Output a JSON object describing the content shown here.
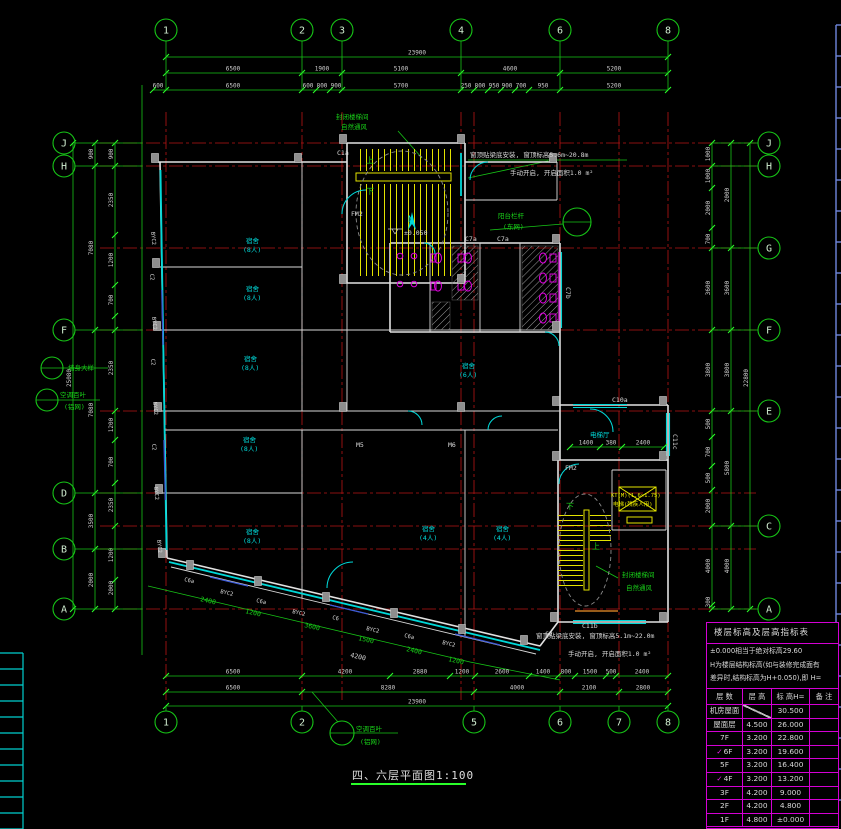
{
  "title_block": {
    "name": "四、六层平面图",
    "scale": "1:100"
  },
  "legend_table": {
    "title": "楼层标高及层高指标表",
    "notes": [
      "±0.000相当于绝对标高29.60",
      "H为楼层结构标高(如与装修完成面有",
      "差异时,结构标高为H+0.050),即 H="
    ],
    "headers": [
      "层 数",
      "层 高",
      "标 高H=",
      "备 注"
    ],
    "check_glyph": "✓",
    "rows": [
      {
        "floor": "机房屋面",
        "height": "",
        "elev": "30.500",
        "remark": "",
        "checked": false,
        "diag": true
      },
      {
        "floor": "屋面层",
        "height": "4.500",
        "elev": "26.000",
        "remark": "",
        "checked": false
      },
      {
        "floor": "7F",
        "height": "3.200",
        "elev": "22.800",
        "remark": "",
        "checked": false
      },
      {
        "floor": "6F",
        "height": "3.200",
        "elev": "19.600",
        "remark": "",
        "checked": true
      },
      {
        "floor": "5F",
        "height": "3.200",
        "elev": "16.400",
        "remark": "",
        "checked": false
      },
      {
        "floor": "4F",
        "height": "3.200",
        "elev": "13.200",
        "remark": "",
        "checked": true
      },
      {
        "floor": "3F",
        "height": "4.200",
        "elev": "9.000",
        "remark": "",
        "checked": false
      },
      {
        "floor": "2F",
        "height": "4.200",
        "elev": "4.800",
        "remark": "",
        "checked": false
      },
      {
        "floor": "1F",
        "height": "4.800",
        "elev": "±0.000",
        "remark": "",
        "checked": false
      }
    ]
  },
  "bubbles": {
    "top": [
      [
        "1",
        166
      ],
      [
        "2",
        302
      ],
      [
        "3",
        342
      ],
      [
        "4",
        461
      ],
      [
        "6",
        560
      ],
      [
        "8",
        668
      ]
    ],
    "bottom": [
      [
        "1",
        166
      ],
      [
        "2",
        302
      ],
      [
        "5",
        474
      ],
      [
        "6",
        560
      ],
      [
        "7",
        619
      ],
      [
        "8",
        668
      ]
    ],
    "left": [
      [
        "J",
        143
      ],
      [
        "H",
        166
      ],
      [
        "F",
        330
      ],
      [
        "D",
        493
      ],
      [
        "B",
        549
      ],
      [
        "A",
        609
      ]
    ],
    "right": [
      [
        "J",
        143
      ],
      [
        "H",
        166
      ],
      [
        "G",
        248
      ],
      [
        "F",
        330
      ],
      [
        "E",
        411
      ],
      [
        "C",
        526
      ],
      [
        "A",
        609
      ]
    ]
  },
  "detail_circles": [
    {
      "x": 52,
      "y": 368,
      "r": 11
    },
    {
      "x": 47,
      "y": 400,
      "r": 11
    },
    {
      "x": 342,
      "y": 733,
      "r": 12
    },
    {
      "x": 577,
      "y": 222,
      "r": 14
    }
  ],
  "dim_chains": [
    {
      "o": "h",
      "p": 57,
      "a": 166,
      "b": 668,
      "t": [
        166,
        668
      ],
      "l": [
        [
          "23900",
          417
        ]
      ]
    },
    {
      "o": "h",
      "p": 73,
      "a": 166,
      "b": 668,
      "t": [
        166,
        302,
        342,
        461,
        560,
        668
      ],
      "l": [
        [
          "6500",
          233
        ],
        [
          "1900",
          322
        ],
        [
          "5100",
          401
        ],
        [
          "4600",
          510
        ],
        [
          "5200",
          614
        ]
      ]
    },
    {
      "o": "h",
      "p": 90,
      "a": 153,
      "b": 668,
      "t": [
        153,
        166,
        302,
        316,
        330,
        342,
        461,
        474,
        488,
        501,
        515,
        529,
        560,
        668
      ],
      "l": [
        [
          "600",
          158
        ],
        [
          "6500",
          233
        ],
        [
          "600",
          308
        ],
        [
          "800",
          322
        ],
        [
          "900",
          336
        ],
        [
          "5700",
          401
        ],
        [
          "250",
          466
        ],
        [
          "800",
          480
        ],
        [
          "950",
          494
        ],
        [
          "900",
          507
        ],
        [
          "700",
          521
        ],
        [
          "950",
          543
        ],
        [
          "5200",
          614
        ]
      ]
    },
    {
      "o": "h",
      "p": 676,
      "a": 166,
      "b": 668,
      "t": [
        166,
        302,
        390,
        450,
        475,
        529,
        558,
        575,
        606,
        616,
        668
      ],
      "l": [
        [
          "6500",
          233
        ],
        [
          "4200",
          345
        ],
        [
          "2880",
          420
        ],
        [
          "1200",
          462
        ],
        [
          "2600",
          502
        ],
        [
          "1400",
          543
        ],
        [
          "800",
          566
        ],
        [
          "1500",
          590
        ],
        [
          "500",
          611
        ],
        [
          "2400",
          642
        ]
      ]
    },
    {
      "o": "h",
      "p": 692,
      "a": 166,
      "b": 668,
      "t": [
        166,
        302,
        474,
        560,
        619,
        668
      ],
      "l": [
        [
          "6500",
          233
        ],
        [
          "8280",
          388
        ],
        [
          "4000",
          517
        ],
        [
          "2100",
          589
        ],
        [
          "2800",
          643
        ]
      ]
    },
    {
      "o": "h",
      "p": 706,
      "a": 166,
      "b": 668,
      "t": [
        166,
        668
      ],
      "l": [
        [
          "23900",
          417
        ]
      ]
    },
    {
      "o": "h",
      "p": 447,
      "a": 570,
      "b": 664,
      "t": [
        570,
        600,
        622,
        664
      ],
      "l": [
        [
          "1400",
          586
        ],
        [
          "380",
          611
        ],
        [
          "2400",
          643
        ]
      ]
    },
    {
      "o": "v",
      "p": 73,
      "a": 143,
      "b": 609,
      "t": [
        143,
        609
      ],
      "l": [
        [
          "25080",
          378
        ]
      ]
    },
    {
      "o": "v",
      "p": 95,
      "a": 143,
      "b": 609,
      "t": [
        143,
        166,
        330,
        493,
        549,
        609
      ],
      "l": [
        [
          "900",
          154
        ],
        [
          "7080",
          248
        ],
        [
          "7080",
          410
        ],
        [
          "3500",
          521
        ],
        [
          "2000",
          580
        ]
      ]
    },
    {
      "o": "v",
      "p": 115,
      "a": 143,
      "b": 609,
      "t": [
        143,
        166,
        235,
        285,
        316,
        330,
        411,
        440,
        483,
        526,
        580,
        609
      ],
      "l": [
        [
          "900",
          154
        ],
        [
          "2350",
          200
        ],
        [
          "1200",
          260
        ],
        [
          "700",
          300
        ],
        [
          "2350",
          368
        ],
        [
          "1200",
          425
        ],
        [
          "700",
          462
        ],
        [
          "2350",
          505
        ],
        [
          "1200",
          555
        ],
        [
          "2000",
          588
        ]
      ]
    },
    {
      "o": "v",
      "p": 712,
      "a": 143,
      "b": 609,
      "t": [
        143,
        166,
        188,
        228,
        248,
        330,
        411,
        437,
        466,
        490,
        526,
        605,
        609
      ],
      "l": [
        [
          "1000",
          154
        ],
        [
          "1000",
          176
        ],
        [
          "2000",
          208
        ],
        [
          "700",
          239
        ],
        [
          "3600",
          288
        ],
        [
          "3800",
          370
        ],
        [
          "500",
          424
        ],
        [
          "700",
          452
        ],
        [
          "500",
          478
        ],
        [
          "2000",
          506
        ],
        [
          "4000",
          566
        ],
        [
          "300",
          602
        ]
      ]
    },
    {
      "o": "v",
      "p": 731,
      "a": 143,
      "b": 609,
      "t": [
        143,
        248,
        330,
        411,
        526,
        609
      ],
      "l": [
        [
          "2000",
          195
        ],
        [
          "3600",
          288
        ],
        [
          "3800",
          370
        ],
        [
          "5800",
          468
        ],
        [
          "4000",
          566
        ]
      ]
    },
    {
      "o": "v",
      "p": 750,
      "a": 143,
      "b": 609,
      "t": [
        143,
        609
      ],
      "l": [
        [
          "22800",
          378
        ]
      ]
    }
  ],
  "texts": [
    {
      "t": "封闭楼梯间",
      "x": 336,
      "y": 119,
      "c": "green"
    },
    {
      "t": "自然通风",
      "x": 341,
      "y": 129,
      "c": "green"
    },
    {
      "t": "窗顶贴梁底安装, 窗顶标高5.6m~20.8m",
      "x": 470,
      "y": 157,
      "c": "white"
    },
    {
      "t": "手动开启, 开启面积1.0 m²",
      "x": 510,
      "y": 175,
      "c": "white"
    },
    {
      "t": "阳台栏杆",
      "x": 498,
      "y": 218,
      "c": "green"
    },
    {
      "t": "(东网)",
      "x": 503,
      "y": 229,
      "c": "green"
    },
    {
      "t": "封闭楼梯间",
      "x": 622,
      "y": 577,
      "c": "green"
    },
    {
      "t": "自然通风",
      "x": 626,
      "y": 590,
      "c": "green"
    },
    {
      "t": "窗顶贴梁底安装, 窗顶标高5.1m~22.0m",
      "x": 536,
      "y": 638,
      "c": "white"
    },
    {
      "t": "手动开启, 开启面积1.0 m²",
      "x": 568,
      "y": 656,
      "c": "white"
    },
    {
      "t": "墙身大样",
      "x": 68,
      "y": 370,
      "c": "green"
    },
    {
      "t": "空调百叶",
      "x": 60,
      "y": 397,
      "c": "green"
    },
    {
      "t": "(铝网)",
      "x": 64,
      "y": 409,
      "c": "green"
    },
    {
      "t": "空调百叶",
      "x": 356,
      "y": 731,
      "c": "green"
    },
    {
      "t": "(铝网)",
      "x": 360,
      "y": 744,
      "c": "green"
    },
    {
      "t": "上",
      "x": 366,
      "y": 163,
      "c": "green",
      "s": 8
    },
    {
      "t": "下",
      "x": 366,
      "y": 194,
      "c": "green",
      "s": 8
    },
    {
      "t": "下",
      "x": 566,
      "y": 509,
      "c": "green",
      "s": 8
    },
    {
      "t": "上",
      "x": 592,
      "y": 549,
      "c": "green",
      "s": 8
    },
    {
      "t": "±0.050",
      "x": 404,
      "y": 235,
      "c": "white"
    },
    {
      "t": "FM2",
      "x": 351,
      "y": 216,
      "c": "white"
    },
    {
      "t": "FM2",
      "x": 565,
      "y": 470,
      "c": "white"
    },
    {
      "t": "C1a",
      "x": 337,
      "y": 155,
      "c": "white"
    },
    {
      "t": "C7a",
      "x": 465,
      "y": 241,
      "c": "white"
    },
    {
      "t": "C7a",
      "x": 497,
      "y": 241,
      "c": "white"
    },
    {
      "t": "C7b",
      "x": 566,
      "y": 287,
      "c": "white",
      "r": 90
    },
    {
      "t": "C10a",
      "x": 612,
      "y": 402,
      "c": "white"
    },
    {
      "t": "C11c",
      "x": 673,
      "y": 434,
      "c": "white",
      "r": 90
    },
    {
      "t": "C11b",
      "x": 582,
      "y": 628,
      "c": "white"
    },
    {
      "t": "C2",
      "x": 545,
      "y": 636,
      "c": "white"
    },
    {
      "t": "M5",
      "x": 356,
      "y": 447,
      "c": "white"
    },
    {
      "t": "M6",
      "x": 448,
      "y": 447,
      "c": "white"
    },
    {
      "t": "4200",
      "x": 350,
      "y": 657,
      "c": "white",
      "r": 13
    },
    {
      "t": "BYC2",
      "x": 151,
      "y": 232,
      "c": "white",
      "s": 5.5,
      "r": 84
    },
    {
      "t": "C2",
      "x": 150,
      "y": 274,
      "c": "white",
      "s": 5.5,
      "r": 84
    },
    {
      "t": "BYC2",
      "x": 152,
      "y": 317,
      "c": "white",
      "s": 5.5,
      "r": 84
    },
    {
      "t": "C2",
      "x": 151,
      "y": 359,
      "c": "white",
      "s": 5.5,
      "r": 84
    },
    {
      "t": "BYC2",
      "x": 153,
      "y": 402,
      "c": "white",
      "s": 5.5,
      "r": 84
    },
    {
      "t": "C2",
      "x": 152,
      "y": 444,
      "c": "white",
      "s": 5.5,
      "r": 84
    },
    {
      "t": "BYC2",
      "x": 154,
      "y": 487,
      "c": "white",
      "s": 5.5,
      "r": 84
    },
    {
      "t": "BYC2",
      "x": 157,
      "y": 540,
      "c": "white",
      "s": 5.5,
      "r": 84
    },
    {
      "t": "C6a",
      "x": 184,
      "y": 581,
      "c": "white",
      "s": 5.5,
      "r": 13
    },
    {
      "t": "BYC2",
      "x": 220,
      "y": 593,
      "c": "white",
      "s": 5.5,
      "r": 13
    },
    {
      "t": "C6a",
      "x": 256,
      "y": 602,
      "c": "white",
      "s": 5.5,
      "r": 13
    },
    {
      "t": "BYC2",
      "x": 292,
      "y": 613,
      "c": "white",
      "s": 5.5,
      "r": 13
    },
    {
      "t": "C6",
      "x": 332,
      "y": 619,
      "c": "white",
      "s": 5.5,
      "r": 13
    },
    {
      "t": "BYC2",
      "x": 366,
      "y": 630,
      "c": "white",
      "s": 5.5,
      "r": 13
    },
    {
      "t": "C6a",
      "x": 404,
      "y": 637,
      "c": "white",
      "s": 5.5,
      "r": 13
    },
    {
      "t": "BYC2",
      "x": 442,
      "y": 644,
      "c": "white",
      "s": 5.5,
      "r": 13
    },
    {
      "t": "2400",
      "x": 200,
      "y": 601,
      "c": "green",
      "r": 13
    },
    {
      "t": "1200",
      "x": 245,
      "y": 613,
      "c": "green",
      "r": 13
    },
    {
      "t": "3600",
      "x": 304,
      "y": 627,
      "c": "green",
      "r": 13
    },
    {
      "t": "1500",
      "x": 358,
      "y": 640,
      "c": "green",
      "r": 13
    },
    {
      "t": "2400",
      "x": 406,
      "y": 651,
      "c": "green",
      "r": 13
    },
    {
      "t": "1200",
      "x": 448,
      "y": 661,
      "c": "green",
      "r": 13
    },
    {
      "t": "宿舍",
      "x": 246,
      "y": 243,
      "c": "cyan"
    },
    {
      "t": "(8人)",
      "x": 243,
      "y": 252,
      "c": "cyan"
    },
    {
      "t": "宿舍",
      "x": 246,
      "y": 291,
      "c": "cyan"
    },
    {
      "t": "(8人)",
      "x": 243,
      "y": 300,
      "c": "cyan"
    },
    {
      "t": "宿舍",
      "x": 244,
      "y": 361,
      "c": "cyan"
    },
    {
      "t": "(8人)",
      "x": 241,
      "y": 370,
      "c": "cyan"
    },
    {
      "t": "宿舍",
      "x": 243,
      "y": 442,
      "c": "cyan"
    },
    {
      "t": "(8人)",
      "x": 240,
      "y": 451,
      "c": "cyan"
    },
    {
      "t": "宿舍",
      "x": 246,
      "y": 534,
      "c": "cyan"
    },
    {
      "t": "(8人)",
      "x": 243,
      "y": 543,
      "c": "cyan"
    },
    {
      "t": "宿舍",
      "x": 462,
      "y": 368,
      "c": "cyan"
    },
    {
      "t": "(6人)",
      "x": 459,
      "y": 377,
      "c": "cyan"
    },
    {
      "t": "宿舍",
      "x": 422,
      "y": 531,
      "c": "cyan"
    },
    {
      "t": "(4人)",
      "x": 419,
      "y": 540,
      "c": "cyan"
    },
    {
      "t": "宿舍",
      "x": 496,
      "y": 531,
      "c": "cyan"
    },
    {
      "t": "(4人)",
      "x": 493,
      "y": 540,
      "c": "cyan"
    },
    {
      "t": "电梯厅",
      "x": 590,
      "y": 437,
      "c": "cyan"
    },
    {
      "t": "N",
      "x": 408,
      "y": 222,
      "c": "cyan",
      "s": 9
    },
    {
      "t": "KT(M)(1.6×1.75)",
      "x": 611,
      "y": 497,
      "c": "yellow",
      "s": 5.5
    },
    {
      "t": "电梯(残疾人用)",
      "x": 613,
      "y": 506,
      "c": "yellow",
      "s": 5.5
    }
  ],
  "colors": {
    "green": "#17c517",
    "red": "#b81414",
    "cyan": "#00d8d8",
    "magenta": "#dc00dc",
    "yellow": "#e4e400",
    "white": "#d9d9d9",
    "blue_ruler": "#6f87dd"
  }
}
